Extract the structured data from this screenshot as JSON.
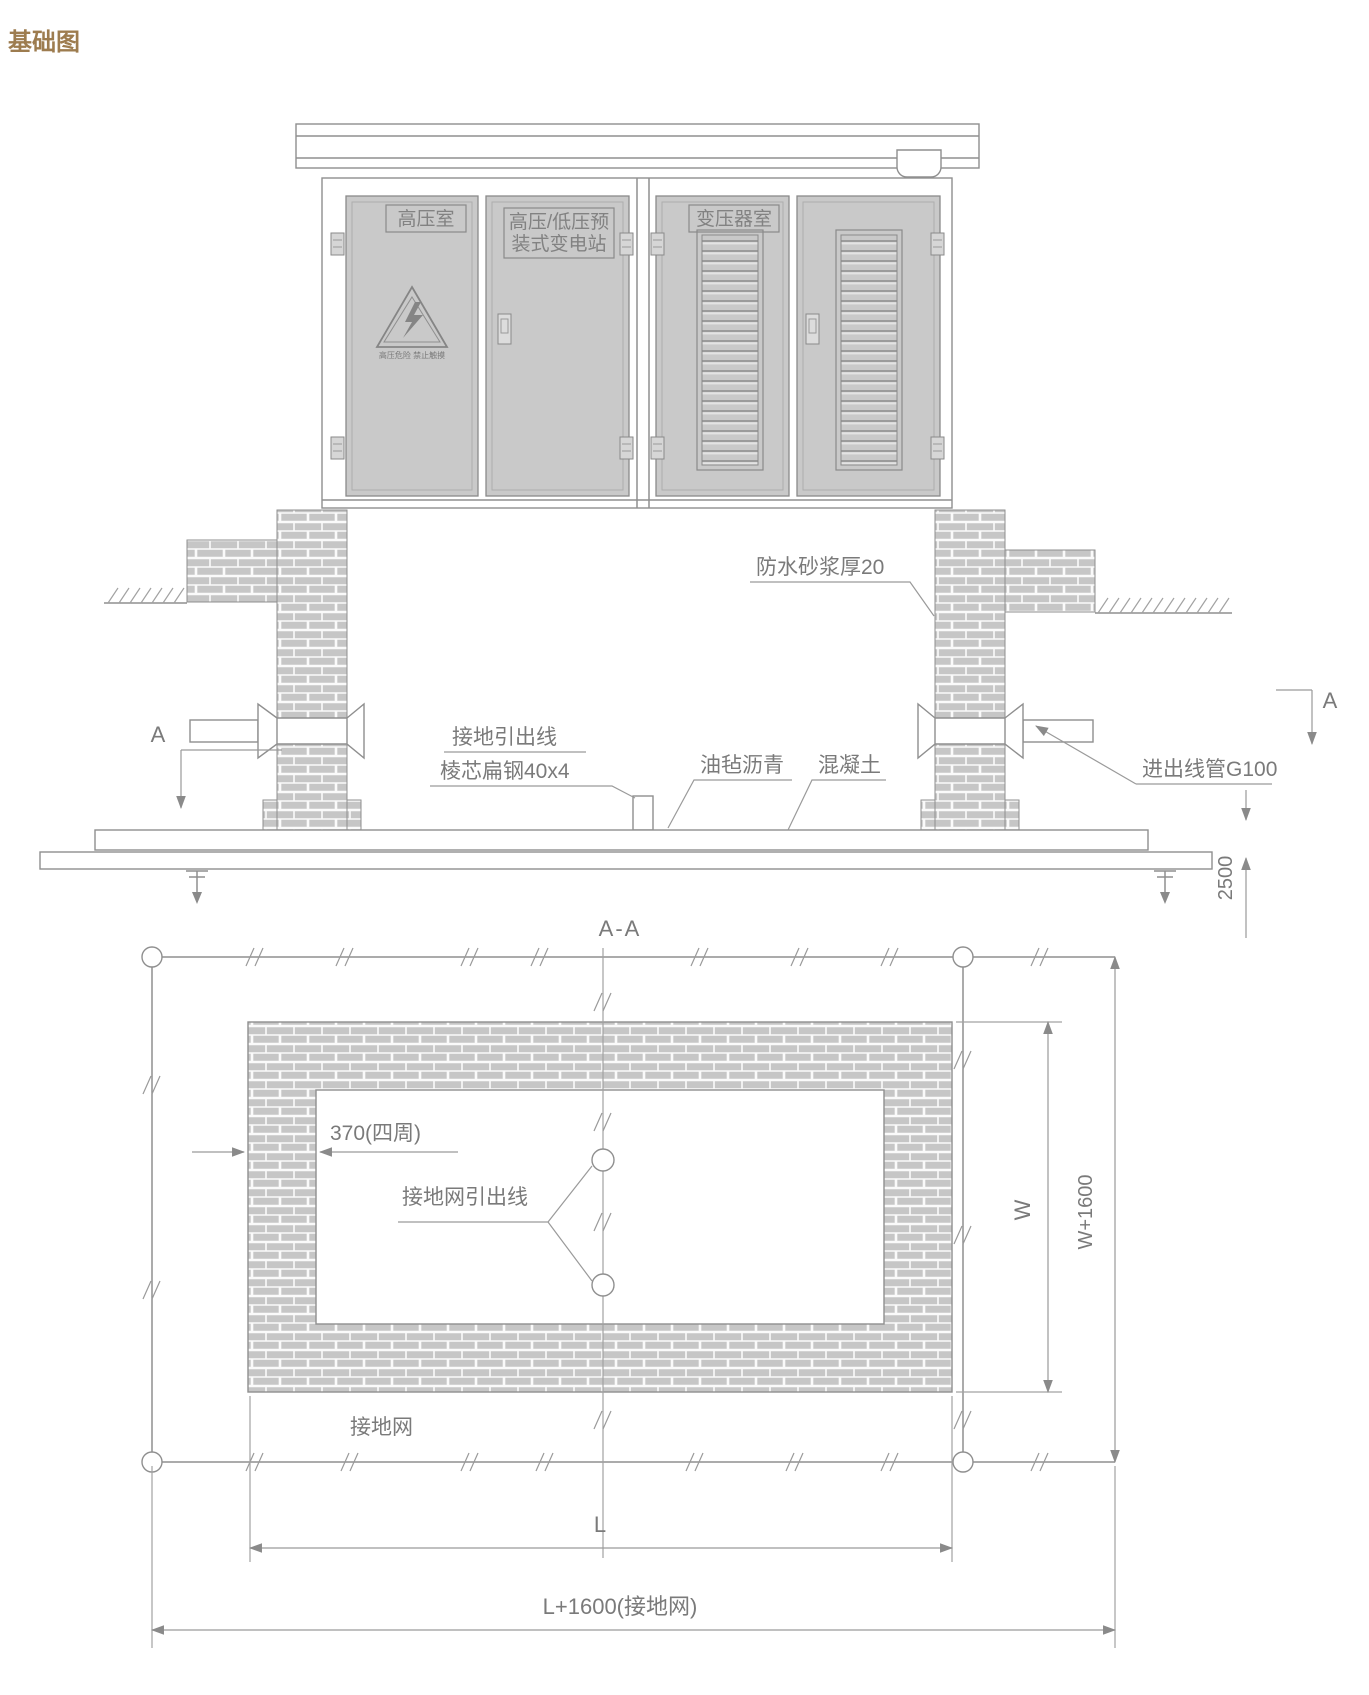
{
  "title": "基础图",
  "elevation": {
    "door_labels": {
      "hv_room": "高压室",
      "prefab_line1": "高压/低压预",
      "prefab_line2": "装式变电站",
      "transformer": "变压器室",
      "warning_text": "高压危险 禁止触摸"
    },
    "annotations": {
      "waterproof": "防水砂浆厚20",
      "ground_lead_line1": "接地引出线",
      "ground_lead_line2": "棱芯扁钢40x4",
      "asphalt": "油毡沥青",
      "concrete": "混凝土",
      "conduit": "进出线管G100",
      "depth_dim": "2500",
      "section_marker": "A"
    }
  },
  "plan": {
    "section_title": "A-A",
    "annotations": {
      "wall_thickness": "370(四周)",
      "grid_lead": "接地网引出线",
      "grid": "接地网",
      "length_dim": "L",
      "length_total_dim": "L+1600(接地网)",
      "width_dim": "W",
      "width_total_dim": "W+1600"
    }
  },
  "colors": {
    "title": "#9d7c4f",
    "line": "#8f8f8f",
    "brick_fill": "#c6c6c6",
    "door_fill": "#c9c9c9",
    "annotation_text": "#7a7a7a"
  }
}
